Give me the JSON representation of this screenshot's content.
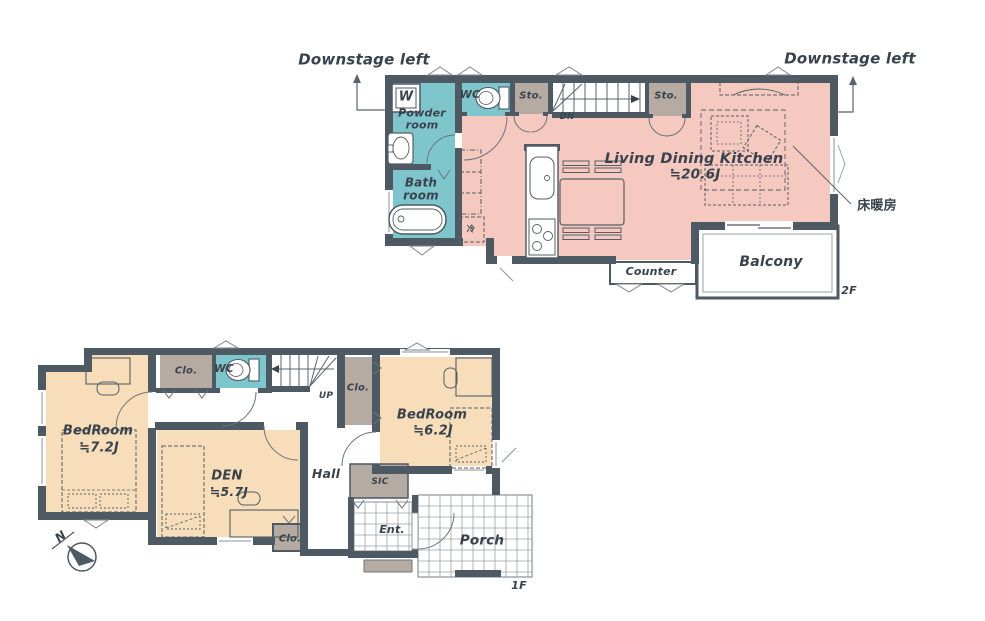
{
  "palette": {
    "wall": "#4d5963",
    "wet_area": "#7fc5cc",
    "ldk": "#f6c9c0",
    "bedroom": "#f7ddb9",
    "storage": "#b5aba2",
    "tile_line": "#9aa2ab",
    "text": "#39434d"
  },
  "floor2": {
    "label": "2F",
    "downstage_left": "Downstage left",
    "downstage_right": "Downstage left",
    "washer": "W",
    "powder_room": "Powder\nroom",
    "wc": "WC",
    "storage_left": "Sto.",
    "storage_right": "Sto.",
    "stairs_down": "DN",
    "bath_room": "Bath\nroom",
    "ldk_name": "Living Dining Kitchen",
    "ldk_area": "≒20.6J",
    "floor_heating_note": "床暖房",
    "fridge": "冷",
    "counter": "Counter",
    "balcony": "Balcony"
  },
  "floor1": {
    "label": "1F",
    "closet_top": "Clo.",
    "wc": "WC",
    "stairs_up": "UP",
    "closet_mid": "Clo.",
    "bedroom_main_name": "BedRoom",
    "bedroom_main_area": "≒7.2J",
    "den_name": "DEN",
    "den_area": "≒5.7J",
    "hall": "Hall",
    "shoe_closet": "SIC",
    "bedroom_second_name": "BedRoom",
    "bedroom_second_area": "≒6.2J",
    "closet_bottom": "Clo.",
    "entrance": "Ent.",
    "porch": "Porch",
    "compass_north": "N"
  }
}
